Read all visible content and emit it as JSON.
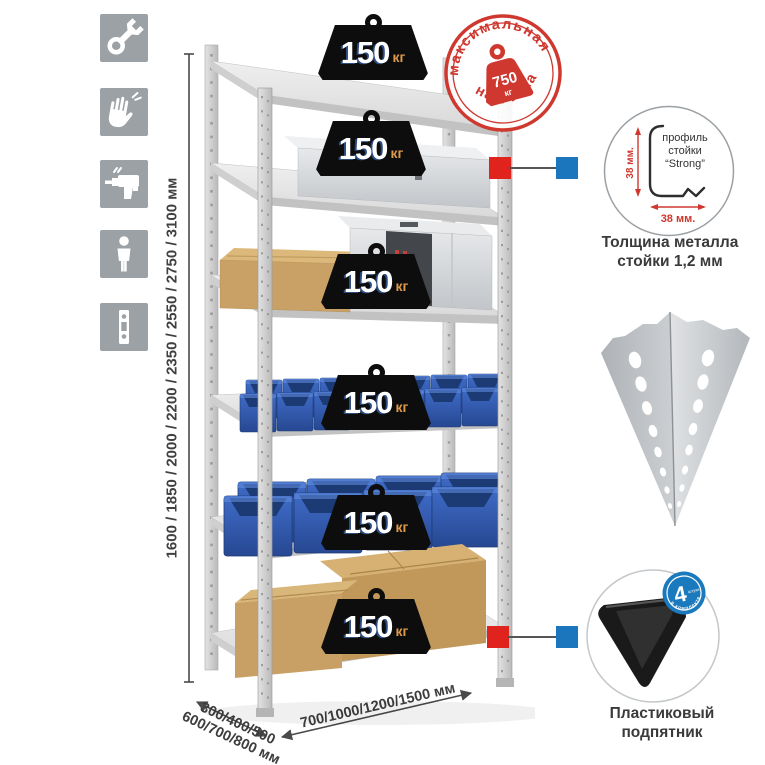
{
  "sidebar": {
    "icons": [
      {
        "name": "wrench"
      },
      {
        "name": "gloves"
      },
      {
        "name": "drill"
      },
      {
        "name": "person"
      },
      {
        "name": "rack-post"
      }
    ]
  },
  "dimensions": {
    "height": "1600 / 1850 / 2000 / 2200 / 2350 / 2550 / 2750 / 3100 мм",
    "depth_line1": "300/400/500",
    "depth_line2": "600/700/800 мм",
    "width": "700/1000/1200/1500 мм"
  },
  "max_load_stamp": {
    "arc_top": "максимальная",
    "arc_bottom": "нагрузка",
    "value": "750",
    "unit": "кг",
    "color": "#cf382f"
  },
  "shelves": {
    "count": 6,
    "loads": [
      {
        "value": "150",
        "unit": "кг"
      },
      {
        "value": "150",
        "unit": "кг"
      },
      {
        "value": "150",
        "unit": "кг"
      },
      {
        "value": "150",
        "unit": "кг"
      },
      {
        "value": "150",
        "unit": "кг"
      },
      {
        "value": "150",
        "unit": "кг"
      }
    ]
  },
  "profile_callout": {
    "title_line1": "профиль",
    "title_line2": "стойки",
    "title_line3": "“Strong”",
    "dim_vertical": "38 мм.",
    "dim_horizontal": "38 мм.",
    "caption_line1": "Толщина металла",
    "caption_line2": "стойки 1,2 мм"
  },
  "foot_callout": {
    "badge_number": "4",
    "badge_small_text": "штуки",
    "badge_arc_text": "в комплекте",
    "caption_line1": "Пластиковый",
    "caption_line2": "подпятник"
  },
  "colors": {
    "accent_red": "#cf382f",
    "accent_blue": "#1b76bd",
    "weight_black": "#0d0d0d",
    "unit_orange": "#dd9a4a",
    "bin_blue": "#2e56a8"
  }
}
